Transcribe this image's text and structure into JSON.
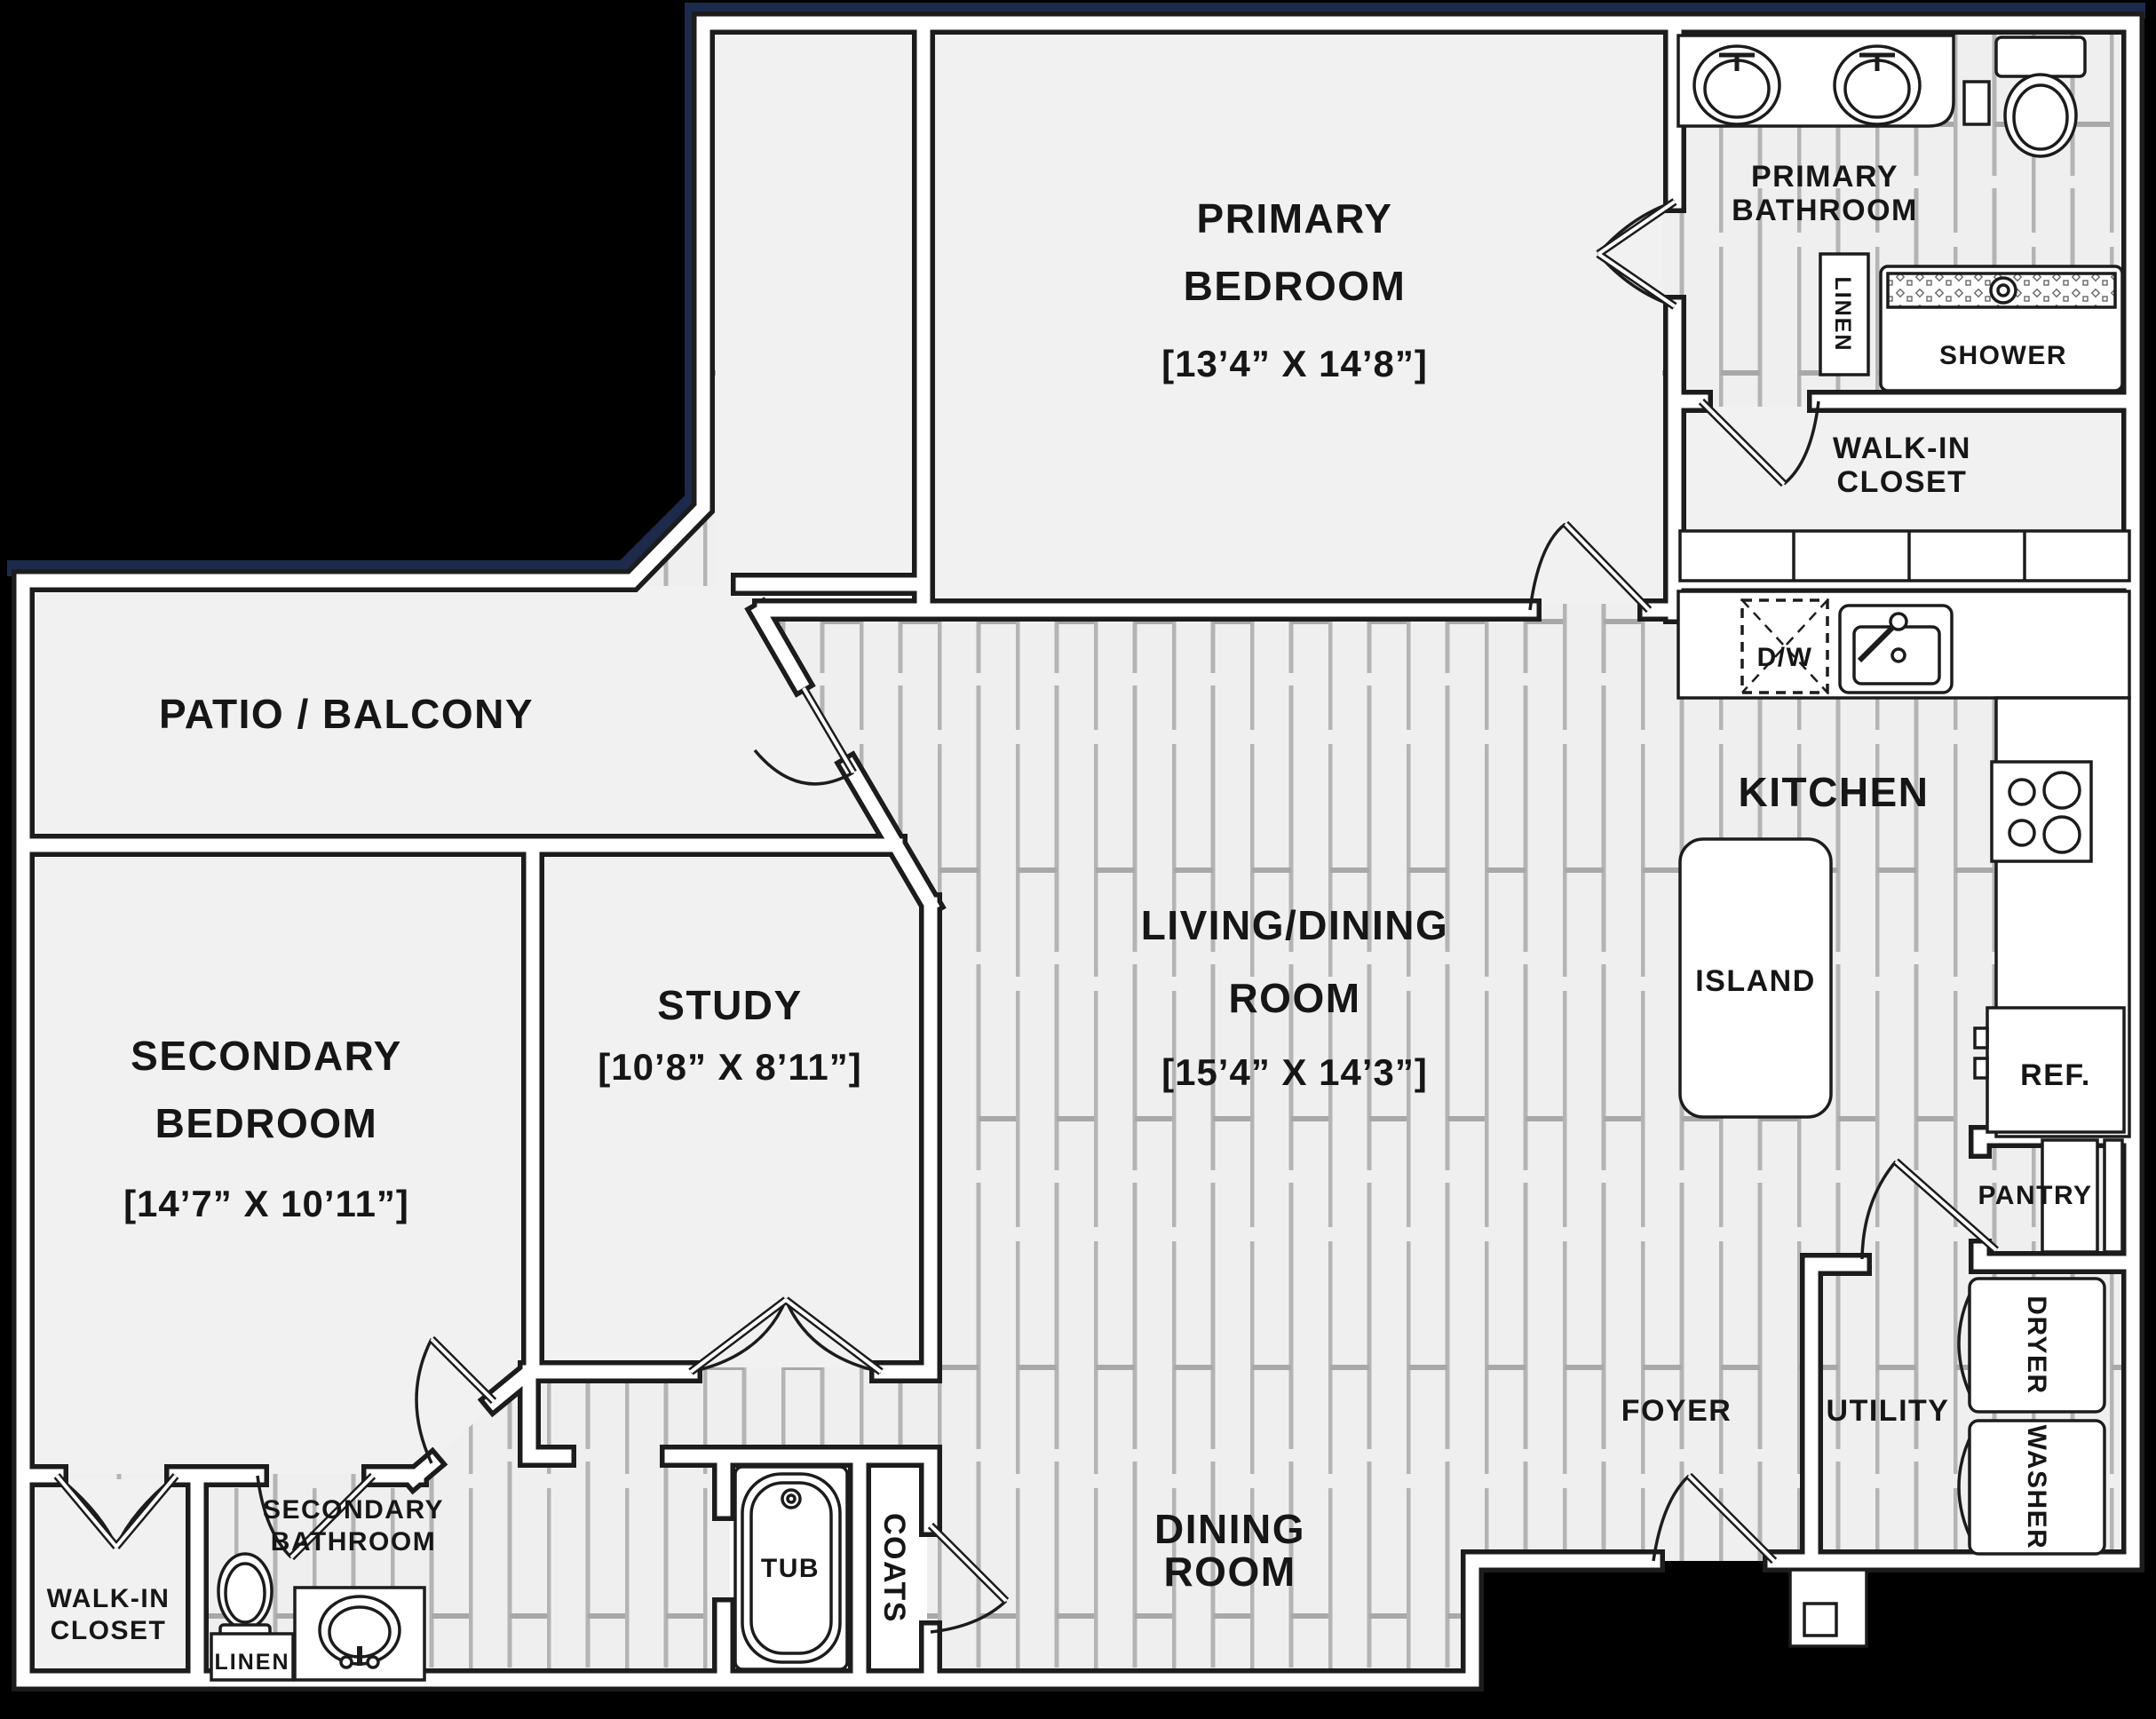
{
  "colors": {
    "background": "#000000",
    "accent_navy": "#1c2a4c",
    "wall_line": "#1c1c1c",
    "wall_fill": "#ffffff",
    "floor_plain": "#f1f1f1",
    "floor_plank": "#efefef",
    "plank_line": "#b4b4b4",
    "label_text": "#161616"
  },
  "rooms": {
    "patio_balcony": {
      "label": "PATIO / BALCONY"
    },
    "primary_bedroom": {
      "line1": "PRIMARY",
      "line2": "BEDROOM",
      "dims": "[13’4” X 14’8”]"
    },
    "primary_bathroom": {
      "line1": "PRIMARY",
      "line2": "BATHROOM"
    },
    "primary_closet": {
      "line1": "WALK-IN",
      "line2": "CLOSET"
    },
    "kitchen": {
      "label": "KITCHEN"
    },
    "living_dining_room": {
      "line1": "LIVING/DINING",
      "line2": "ROOM",
      "dims": "[15’4” X 14’3”]"
    },
    "study": {
      "label": "STUDY",
      "dims": "[10’8” X 8’11”]"
    },
    "secondary_bedroom": {
      "line1": "SECONDARY",
      "line2": "BEDROOM",
      "dims": "[14’7” X 10’11”]"
    },
    "secondary_closet": {
      "line1": "WALK-IN",
      "line2": "CLOSET"
    },
    "secondary_bathroom": {
      "line1": "SECONDARY",
      "line2": "BATHROOM"
    },
    "dining_room": {
      "line1": "DINING",
      "line2": "ROOM"
    },
    "foyer": {
      "label": "FOYER"
    },
    "utility": {
      "label": "UTILITY"
    }
  },
  "fixtures": {
    "shower": "SHOWER",
    "linen_primary": "LINEN",
    "linen_secondary": "LINEN",
    "tub": "TUB",
    "coats": "COATS",
    "island": "ISLAND",
    "dishwasher": "D/W",
    "refrigerator": "REF.",
    "pantry": "PANTRY",
    "dryer": "DRYER",
    "washer": "WASHER"
  }
}
